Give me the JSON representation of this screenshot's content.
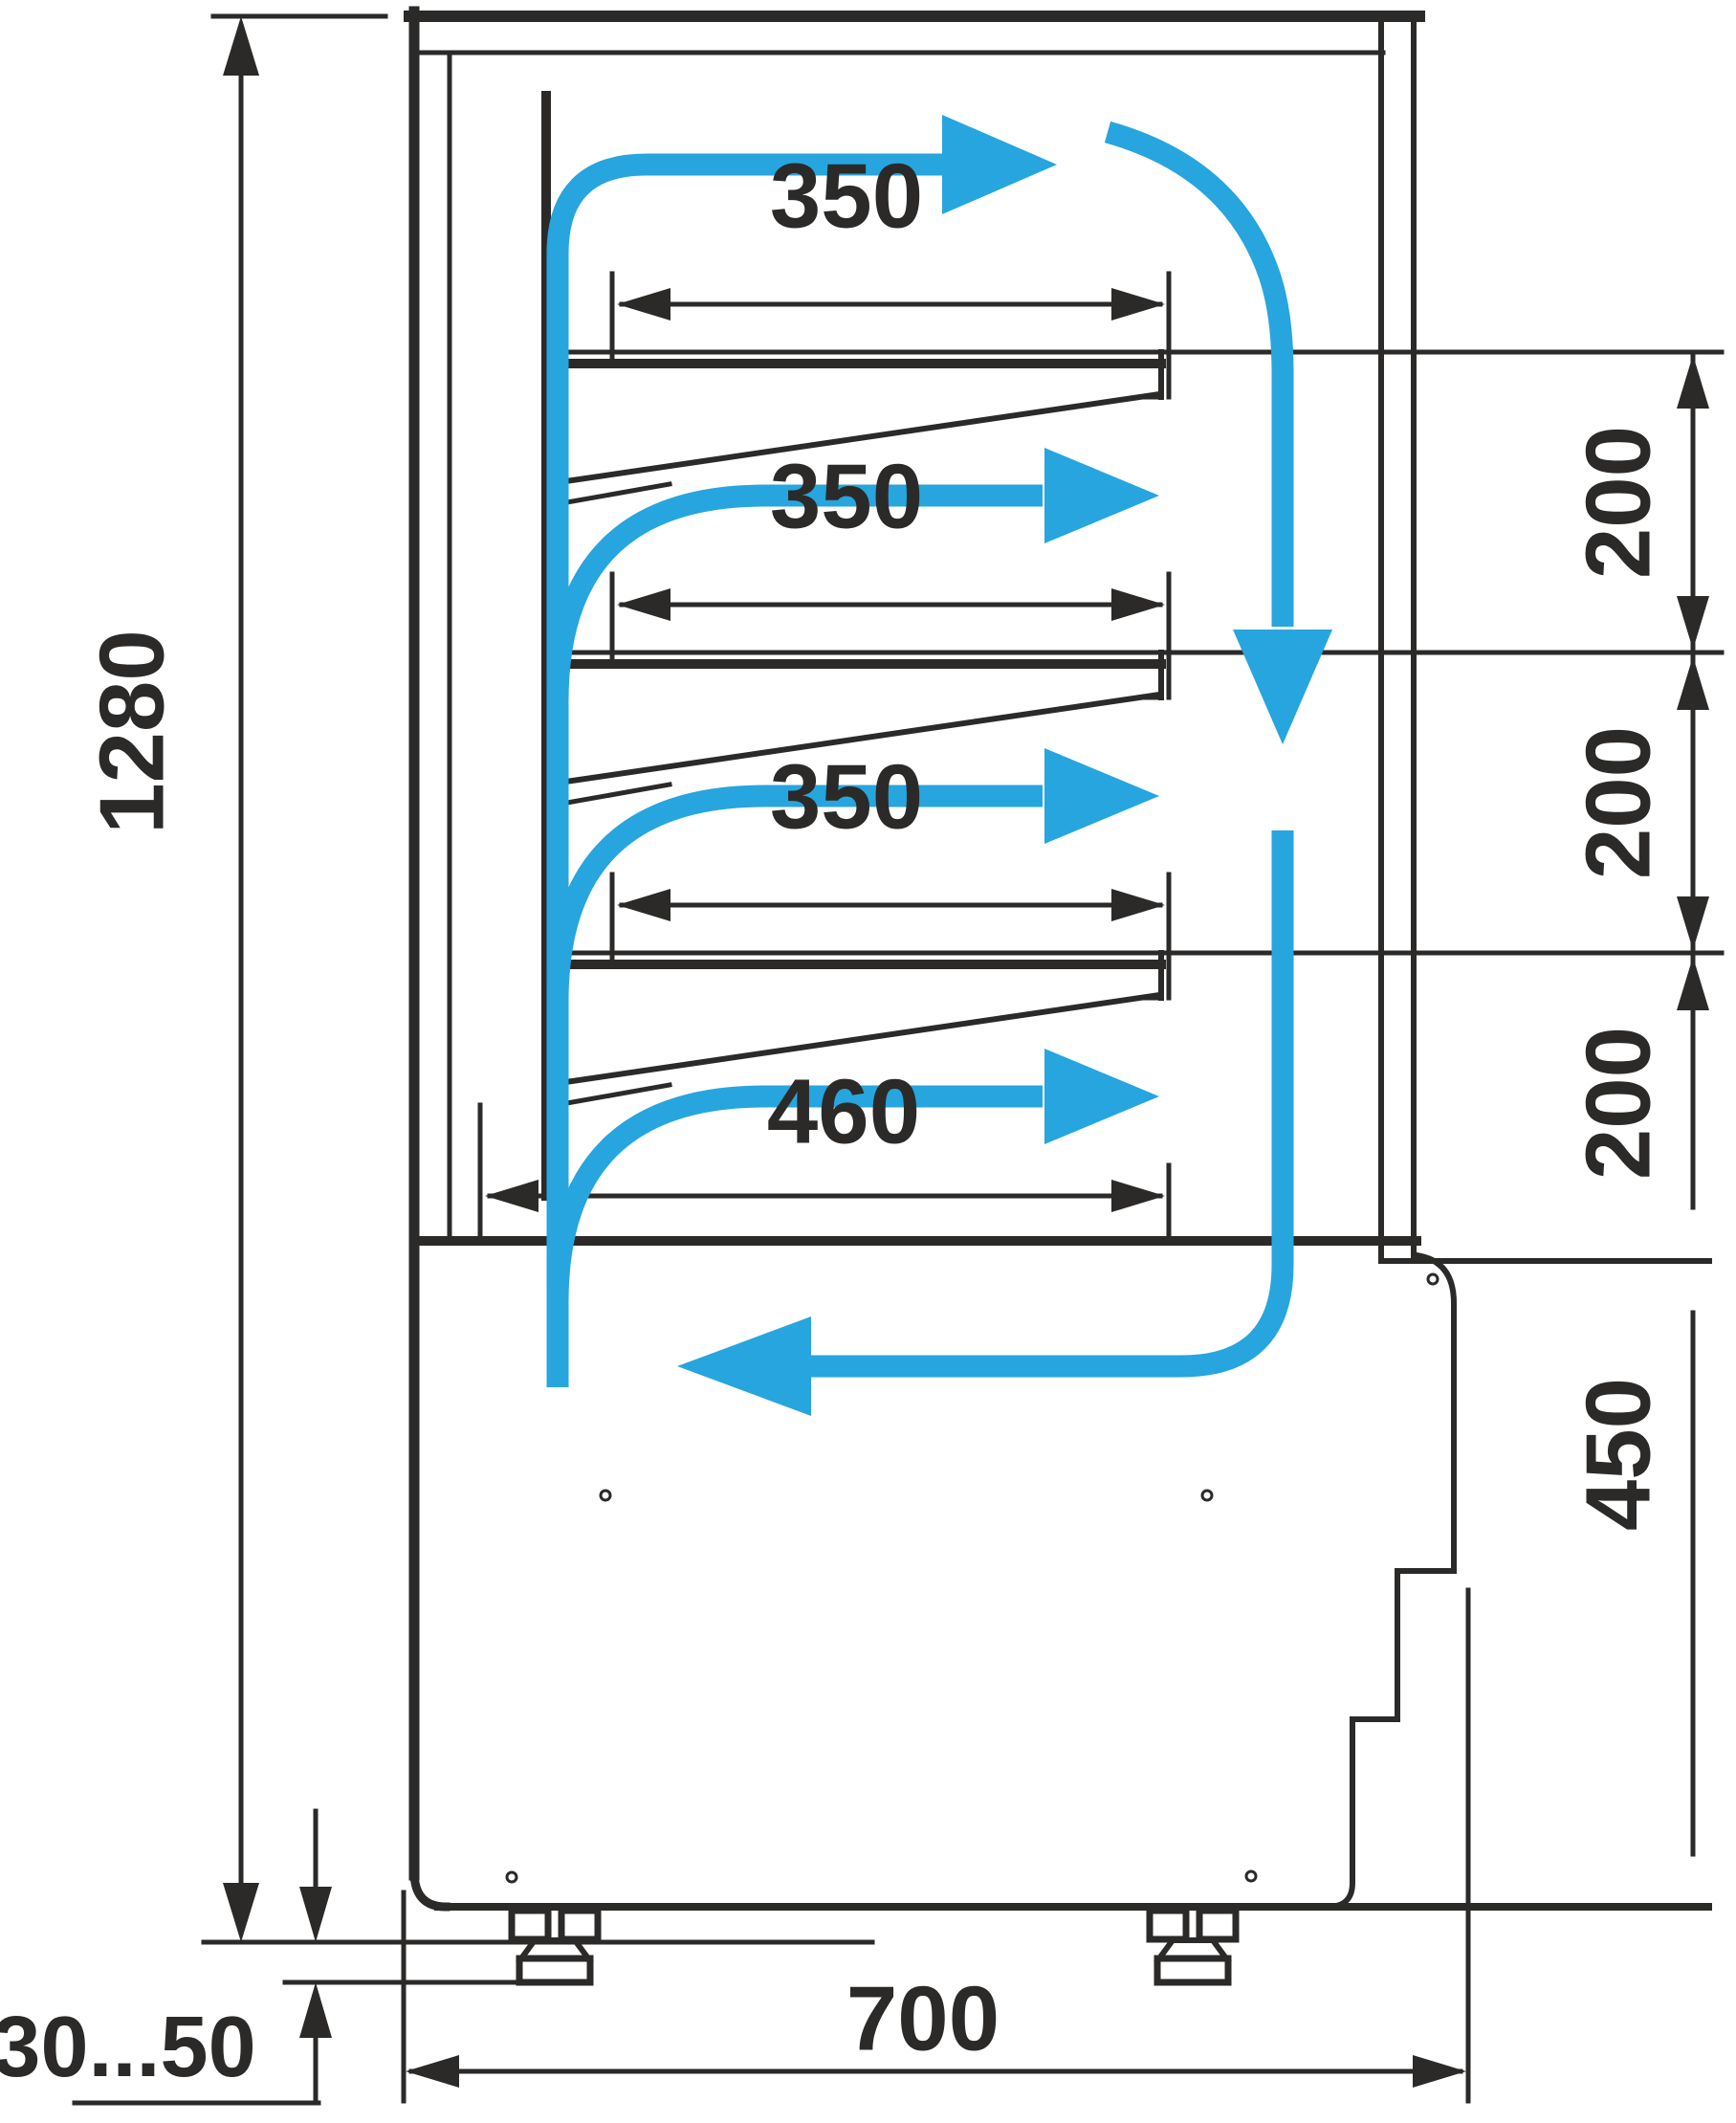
{
  "title": "refrigerated-display-case-side-section-drawing",
  "colors": {
    "ink": "#2b2a29",
    "flow": "#27a5de",
    "background": "#ffffff"
  },
  "dimensions": {
    "total_height": "1280",
    "shelf_depths": [
      "350",
      "350",
      "350"
    ],
    "bottom_shelf_depth": "460",
    "shelf_spacings": [
      "200",
      "200",
      "200"
    ],
    "base_height": "450",
    "base_depth": "700",
    "leg_adjustment_range": "30...50"
  }
}
